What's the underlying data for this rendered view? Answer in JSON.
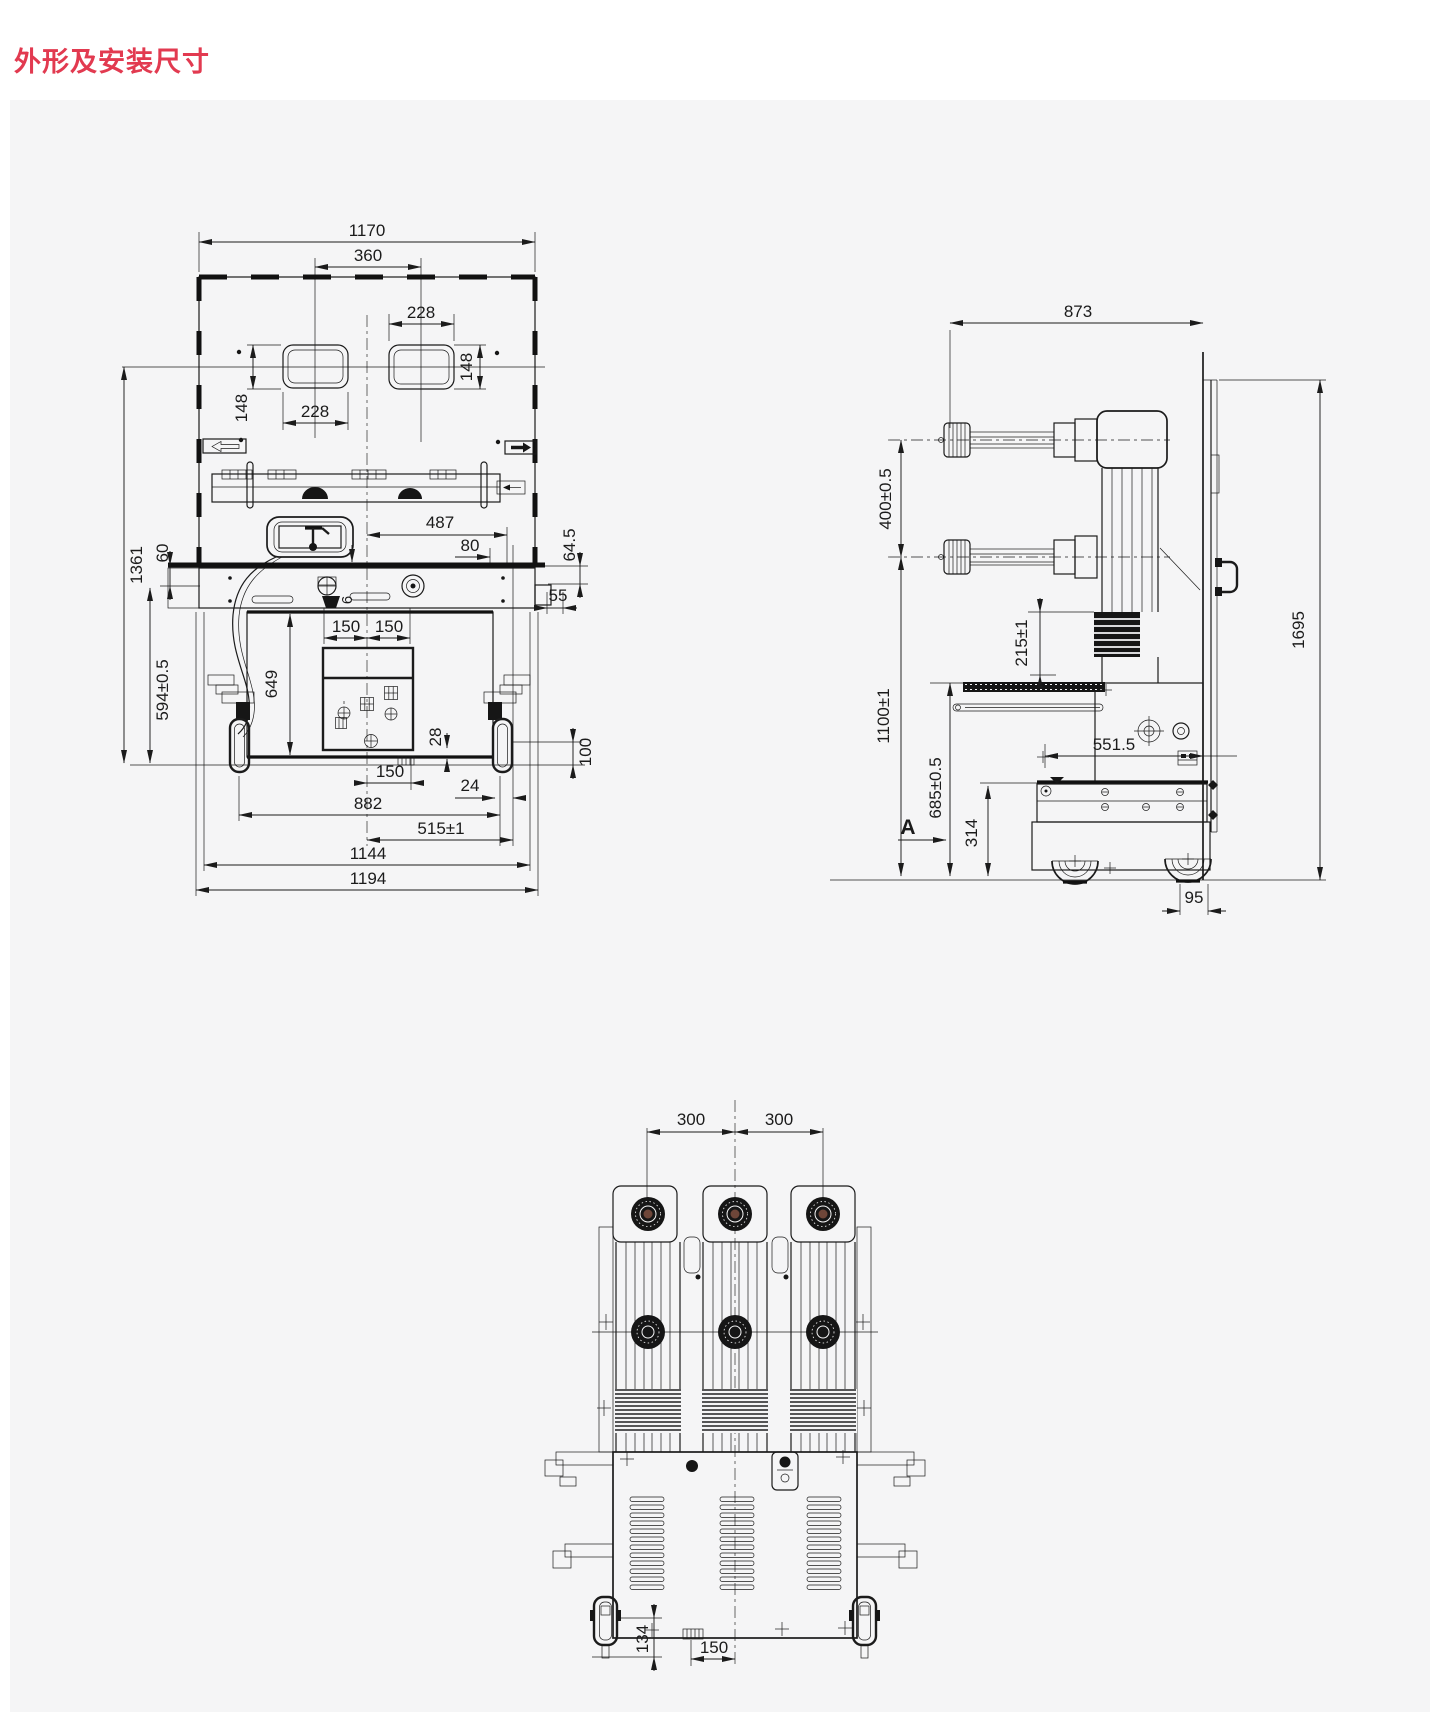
{
  "page": {
    "title": "外形及安装尺寸",
    "title_color": "#e23a50",
    "canvas_color": "#f5f5f6",
    "line_color": "#1b1b1b"
  },
  "views": {
    "front": {
      "dims": {
        "overall_width": "1170",
        "spout_spacing": "360",
        "upper_spout_width": "228",
        "upper_spout_height": "148",
        "lower_spout_width": "228",
        "lower_spout_height": "148",
        "rail_length": "487",
        "shutter_offset": "80",
        "beam_drop": "64.5",
        "side_tab": "55",
        "pin_offset": "6",
        "bolt_left": "150",
        "bolt_right": "150",
        "overall_height": "1361",
        "beam_step": "60",
        "lower_height": "594±0.5",
        "body_height": "649",
        "notch_height": "28",
        "wheel_zone": "100",
        "base_slot": "150",
        "wheel_offset": "24",
        "wheel_span": "882",
        "guide_span": "515±1",
        "frame_width": "1144",
        "overall_base_width": "1194"
      }
    },
    "side": {
      "dims": {
        "depth": "873",
        "arm_spacing": "400±0.5",
        "pole_section": "215±1",
        "arm_height": "1100±1",
        "mech_height": "685±0.5",
        "rail_depth": "551.5",
        "base_height": "314",
        "overall_height": "1695",
        "wheel_inset": "95",
        "section_label": "A"
      }
    },
    "rear": {
      "dims": {
        "pole_pitch_left": "300",
        "pole_pitch_right": "300",
        "foot_height": "134",
        "base_slot": "150"
      }
    }
  }
}
